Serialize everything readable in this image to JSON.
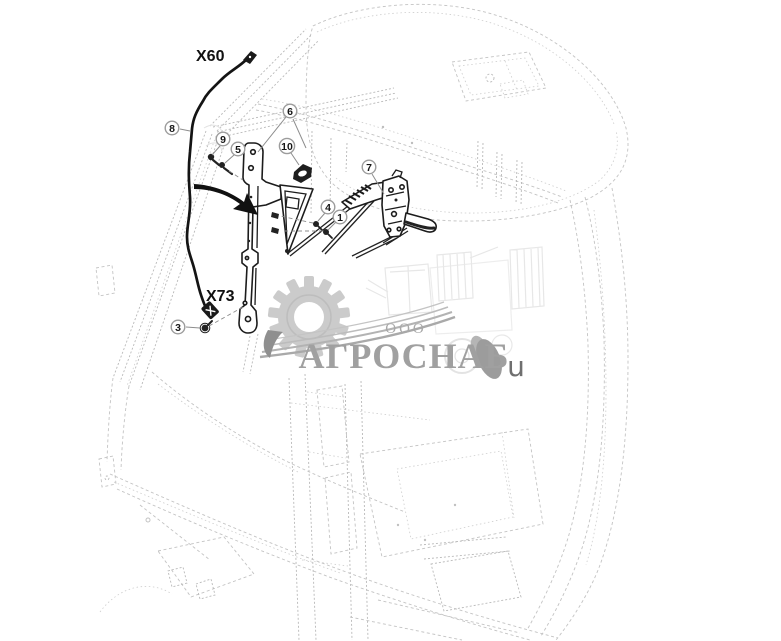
{
  "diagram": {
    "harness_labels": {
      "upper": "X60",
      "lower": "X73"
    },
    "callouts": [
      {
        "n": "1"
      },
      {
        "n": "3"
      },
      {
        "n": "4"
      },
      {
        "n": "5"
      },
      {
        "n": "6"
      },
      {
        "n": "7"
      },
      {
        "n": "8"
      },
      {
        "n": "9"
      },
      {
        "n": "10"
      }
    ]
  },
  "watermark": {
    "org_form": "ООО",
    "name": "АГРОСНАБ",
    "stray": "u"
  },
  "colors": {
    "background": "#ffffff",
    "part_line": "#1c1c1c",
    "ghost_line": "#c3c3c3",
    "callout_ring": "#9c9c9c",
    "watermark_gray": "#a0a0a0"
  }
}
